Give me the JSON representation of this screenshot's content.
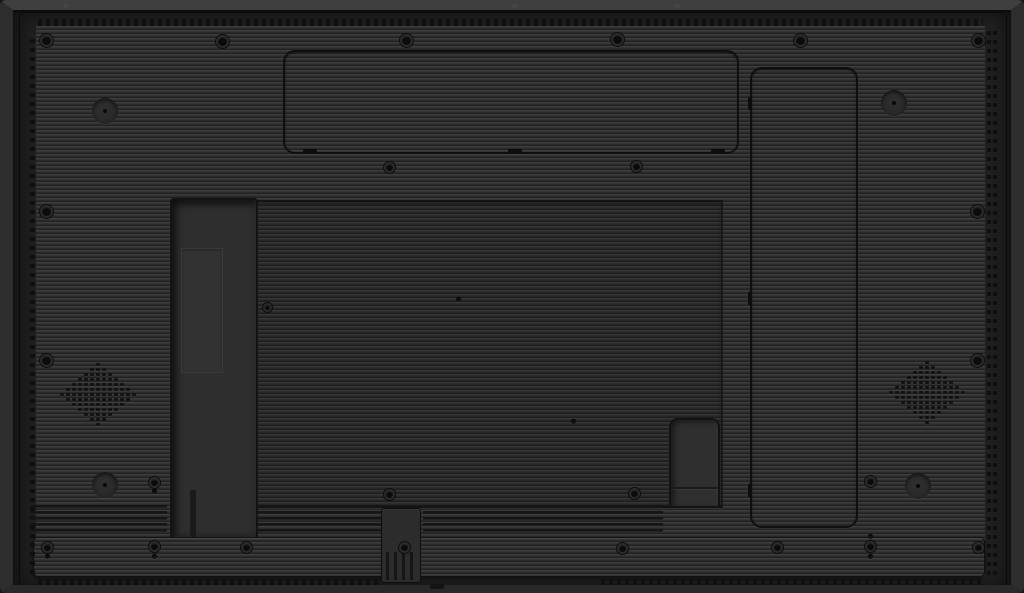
{
  "scene": {
    "label": "Rear view of a black flat-panel display with ribbed back cover, speaker grilles, vent strips and access panels"
  },
  "colors": {
    "edge_top": "#3f3f3f",
    "edge_side": "#2d2d2d",
    "edge_bottom": "#292929",
    "bezel": "#161616",
    "face": "#202020",
    "rib_light": "#3d3d3d",
    "rib_mid": "#333333",
    "rib_dark": "#212121",
    "line": "#0f0f0f",
    "recess": "#2e2e2e",
    "dot": "#0f0f0f",
    "slot": "#151515",
    "speaker_dot": "#121212",
    "screw": "#0b0b0b",
    "screw_ring": "#2b2b2b"
  },
  "panels": {
    "top_access": {
      "x": 283,
      "y": 50,
      "w": 456,
      "h": 104,
      "tabs": [
        [
          303,
          149
        ],
        [
          508,
          149
        ],
        [
          711,
          149
        ]
      ]
    },
    "side_access": {
      "x": 750,
      "y": 67,
      "w": 108,
      "h": 461,
      "tabs": [
        [
          748,
          97
        ],
        [
          748,
          292
        ],
        [
          748,
          484
        ]
      ]
    },
    "central": {
      "x": 170,
      "y": 200,
      "w": 553,
      "h": 308
    },
    "stand_channel": {
      "x": 170,
      "y": 198,
      "w": 88,
      "h": 339,
      "inner": {
        "x": 181,
        "y": 248,
        "w": 42,
        "h": 125
      },
      "split": {
        "x": 190,
        "y": 490,
        "w": 6,
        "h": 47
      }
    },
    "small_door": {
      "x": 669,
      "y": 418,
      "w": 51,
      "h": 90
    },
    "bottom_bar": {
      "x": 33,
      "y": 537,
      "w": 952,
      "h": 40
    },
    "cable_block": {
      "x": 381,
      "y": 508,
      "w": 40,
      "h": 75
    }
  },
  "vents": {
    "top": [
      {
        "x": 38,
        "y": 19,
        "w": 945,
        "h": 7
      }
    ],
    "bottom": [
      {
        "x": 38,
        "y": 579,
        "w": 342,
        "h": 7
      },
      {
        "x": 601,
        "y": 579,
        "w": 384,
        "h": 7
      }
    ],
    "left": [
      {
        "x": 30,
        "y": 34,
        "w": 5,
        "h": 540
      }
    ],
    "right": [
      {
        "x": 987,
        "y": 30,
        "w": 4,
        "h": 545
      },
      {
        "x": 993,
        "y": 30,
        "w": 4,
        "h": 545
      }
    ],
    "slot_bands": [
      {
        "x": 30,
        "y": 505,
        "w": 137,
        "h": 30
      },
      {
        "x": 258,
        "y": 505,
        "w": 125,
        "h": 30
      },
      {
        "x": 423,
        "y": 505,
        "w": 240,
        "h": 30
      }
    ],
    "comb": {
      "x": 386,
      "y": 552,
      "w": 30,
      "h": 28
    }
  },
  "screws": [
    {
      "x": 46,
      "y": 40,
      "d": 13
    },
    {
      "x": 222,
      "y": 41,
      "d": 13
    },
    {
      "x": 406,
      "y": 40,
      "d": 13
    },
    {
      "x": 617,
      "y": 39,
      "d": 13
    },
    {
      "x": 800,
      "y": 40,
      "d": 13
    },
    {
      "x": 978,
      "y": 40,
      "d": 13
    },
    {
      "x": 46,
      "y": 211,
      "d": 13
    },
    {
      "x": 46,
      "y": 360,
      "d": 13
    },
    {
      "x": 977,
      "y": 211,
      "d": 13
    },
    {
      "x": 977,
      "y": 360,
      "d": 13
    },
    {
      "x": 389,
      "y": 167,
      "d": 11
    },
    {
      "x": 636,
      "y": 166,
      "d": 11
    },
    {
      "x": 389,
      "y": 494,
      "d": 11
    },
    {
      "x": 634,
      "y": 493,
      "d": 11
    },
    {
      "x": 870,
      "y": 481,
      "d": 11
    },
    {
      "x": 154,
      "y": 482,
      "d": 11
    },
    {
      "x": 267,
      "y": 307,
      "d": 9
    },
    {
      "x": 47,
      "y": 547,
      "d": 11
    },
    {
      "x": 154,
      "y": 546,
      "d": 11
    },
    {
      "x": 246,
      "y": 547,
      "d": 11
    },
    {
      "x": 404,
      "y": 547,
      "d": 11
    },
    {
      "x": 622,
      "y": 548,
      "d": 11
    },
    {
      "x": 777,
      "y": 547,
      "d": 11
    },
    {
      "x": 870,
      "y": 546,
      "d": 11
    },
    {
      "x": 978,
      "y": 547,
      "d": 11
    }
  ],
  "pinholes": [
    {
      "x": 154,
      "y": 491
    },
    {
      "x": 154,
      "y": 556
    },
    {
      "x": 870,
      "y": 536
    },
    {
      "x": 870,
      "y": 556
    },
    {
      "x": 47,
      "y": 556
    },
    {
      "x": 458,
      "y": 299
    },
    {
      "x": 573,
      "y": 421
    }
  ],
  "recesses": [
    {
      "x": 105,
      "y": 111
    },
    {
      "x": 894,
      "y": 103
    },
    {
      "x": 105,
      "y": 485
    },
    {
      "x": 918,
      "y": 486
    }
  ],
  "speakers": {
    "rows": [
      1,
      3,
      5,
      7,
      9,
      11,
      13,
      11,
      9,
      7,
      5,
      3,
      1
    ],
    "dot": {
      "w": 4,
      "h": 3,
      "gx": 2,
      "gy": 2
    },
    "centers": [
      {
        "x": 98,
        "y": 394
      },
      {
        "x": 927,
        "y": 392
      }
    ]
  },
  "edge_marks": [
    {
      "x": 63,
      "y": 4
    },
    {
      "x": 512,
      "y": 4
    },
    {
      "x": 675,
      "y": 4
    }
  ],
  "bottom_notch": {
    "x": 430,
    "y": 584,
    "w": 14,
    "h": 5
  }
}
